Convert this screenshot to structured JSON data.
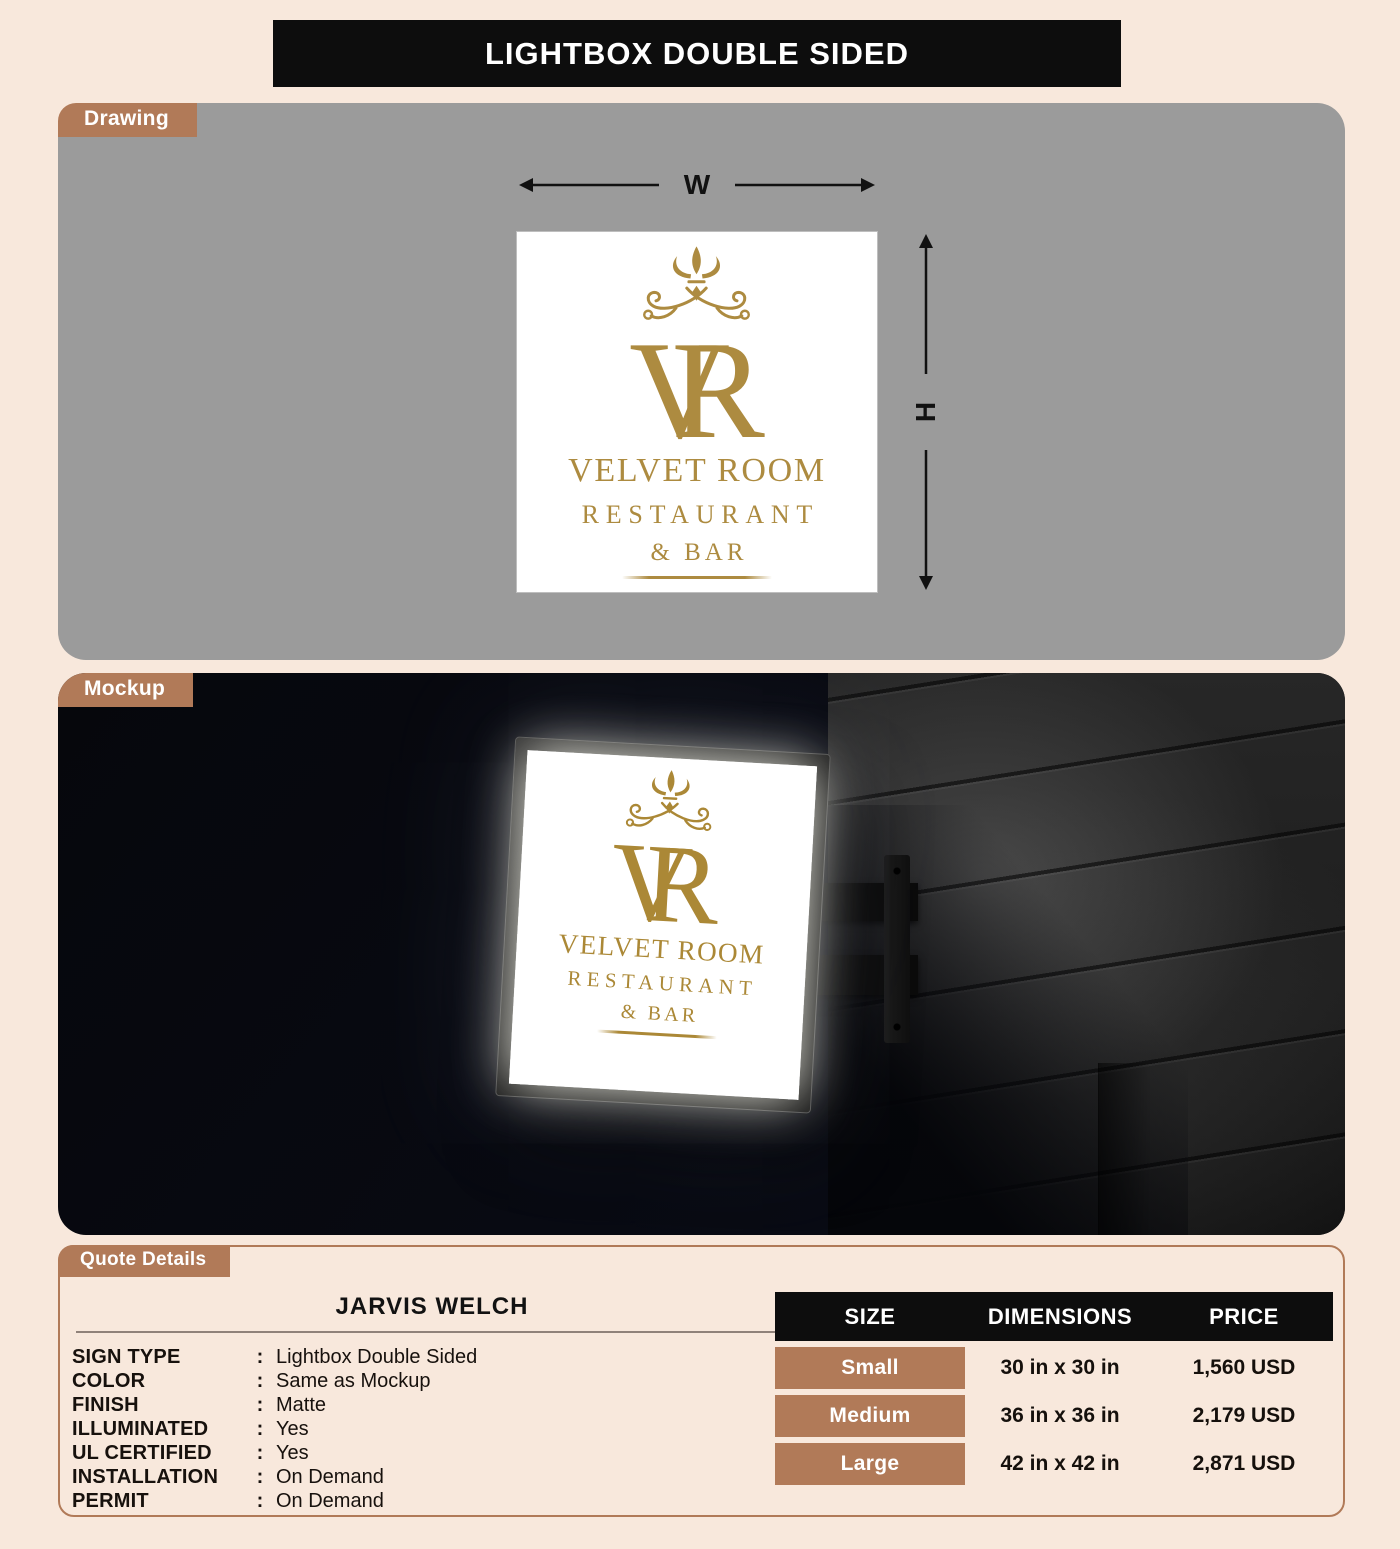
{
  "title": "LIGHTBOX DOUBLE SIDED",
  "drawing": {
    "tab": "Drawing",
    "width_label": "W",
    "height_label": "H"
  },
  "mockup": {
    "tab": "Mockup"
  },
  "logo": {
    "monogram_v": "V",
    "monogram_r": "R",
    "name": "VELVET ROOM",
    "line2": "RESTAURANT",
    "line3": "& BAR"
  },
  "quote": {
    "tab": "Quote Details",
    "customer_name": "JARVIS WELCH",
    "colon": ":",
    "details": [
      {
        "label": "SIGN TYPE",
        "value": "Lightbox Double Sided"
      },
      {
        "label": "COLOR",
        "value": "Same as Mockup"
      },
      {
        "label": "FINISH",
        "value": "Matte"
      },
      {
        "label": "ILLUMINATED",
        "value": "Yes"
      },
      {
        "label": "UL CERTIFIED",
        "value": "Yes"
      },
      {
        "label": "INSTALLATION",
        "value": "On Demand"
      },
      {
        "label": "PERMIT",
        "value": "On Demand"
      }
    ],
    "table": {
      "headers": [
        "SIZE",
        "DIMENSIONS",
        "PRICE"
      ],
      "rows": [
        {
          "size": "Small",
          "dimensions": "30 in x 30 in",
          "price": "1,560 USD"
        },
        {
          "size": "Medium",
          "dimensions": "36 in x 36 in",
          "price": "2,179 USD"
        },
        {
          "size": "Large",
          "dimensions": "42 in x 42 in",
          "price": "2,871 USD"
        }
      ]
    }
  },
  "colors": {
    "accent_brown": "#b17a58",
    "gold": "#ad8b40",
    "cream_background": "#f8e8dc",
    "drawing_gray": "#9b9b9b",
    "header_black": "#0d0d0d"
  }
}
